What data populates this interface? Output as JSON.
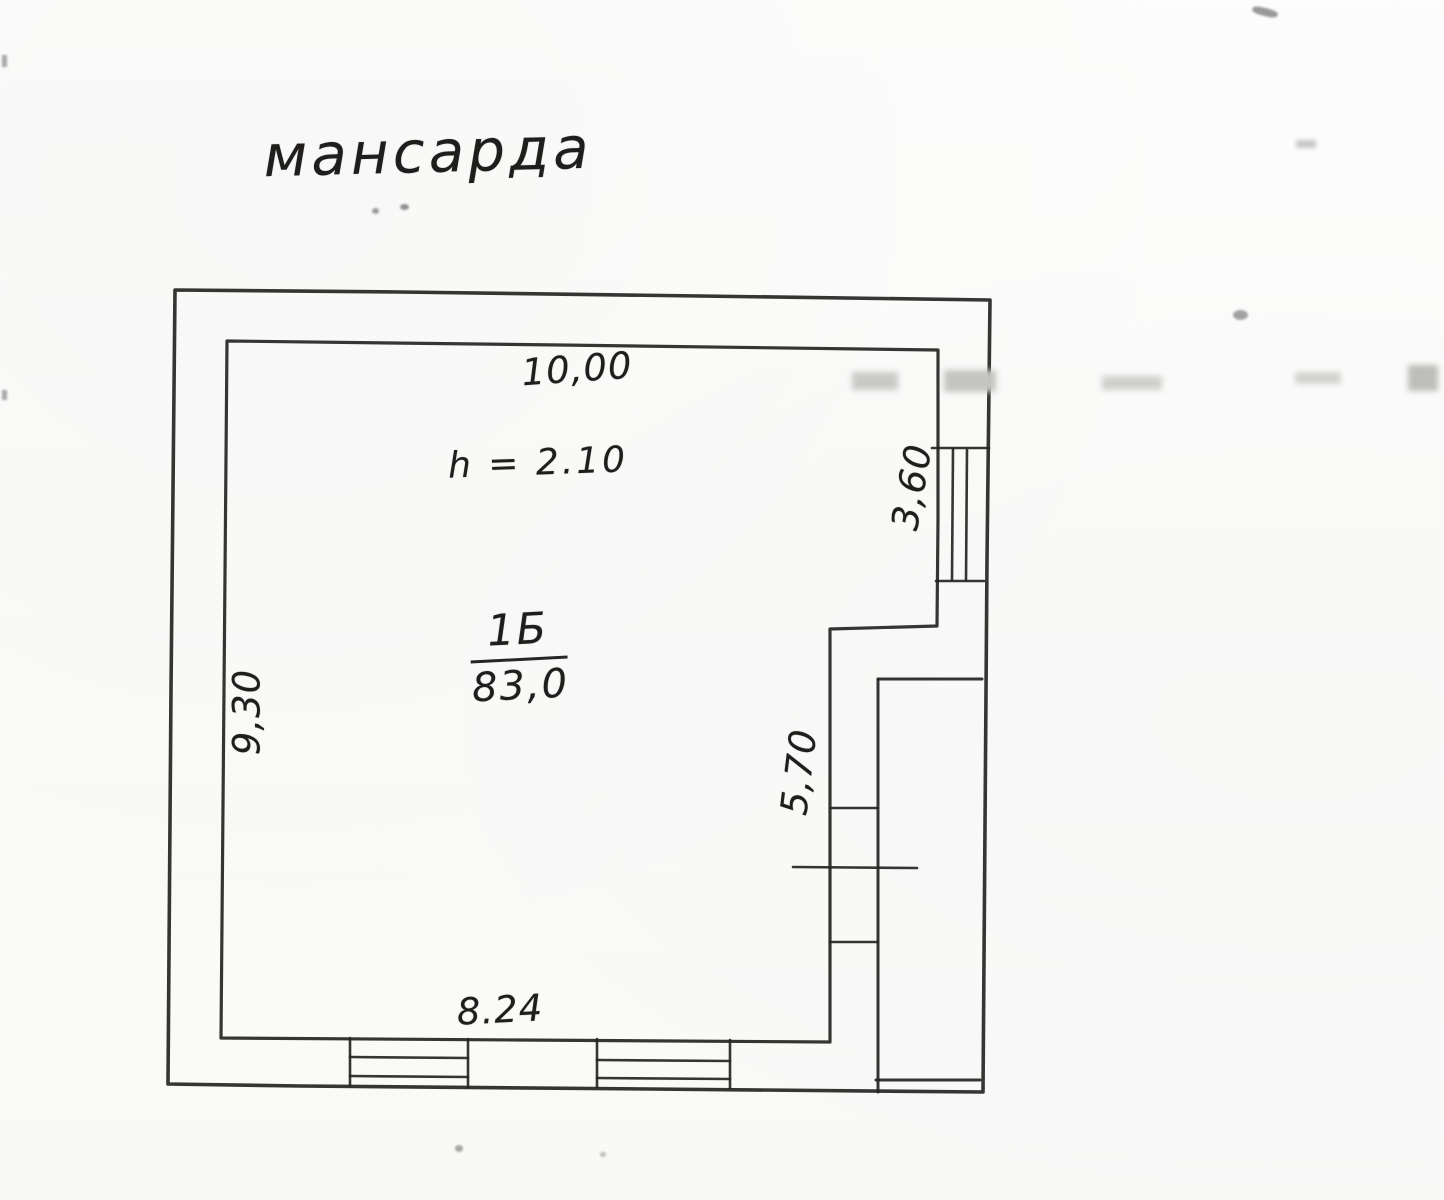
{
  "plan": {
    "title": "мансарда",
    "height_note": "h = 2.10",
    "room": {
      "number": "1Б",
      "area": "83,0"
    },
    "dimensions": {
      "top": "10,00",
      "left": "9,30",
      "bottom": "8.24",
      "right_upper": "3,60",
      "right_lower": "5,70"
    },
    "colors": {
      "ink": "#272625",
      "paper": "#fbfbfa"
    }
  }
}
